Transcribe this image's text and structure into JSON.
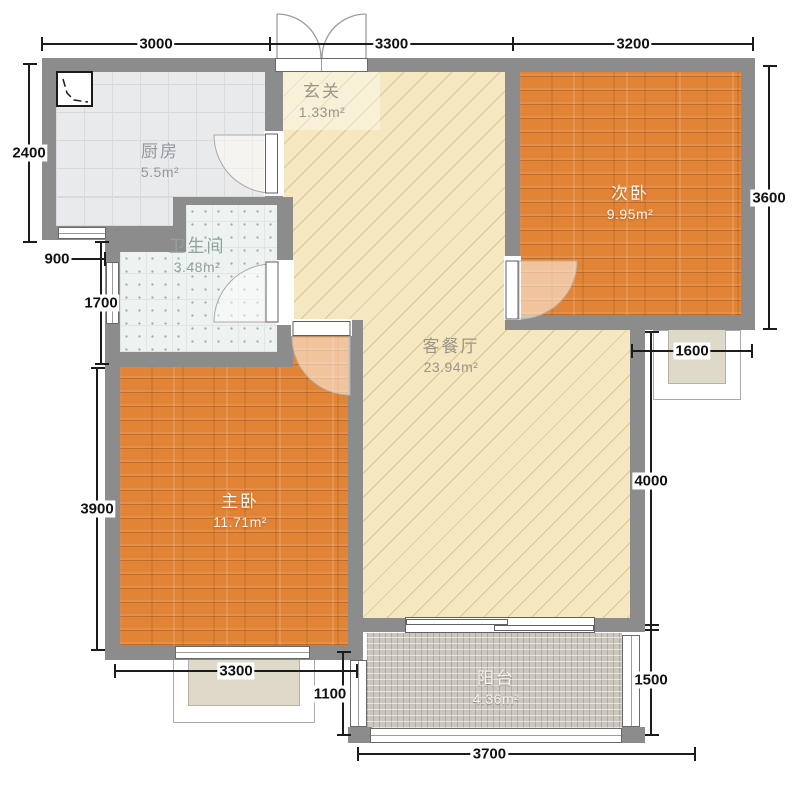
{
  "plan": {
    "rooms": {
      "kitchen": {
        "name": "厨房",
        "area": "5.5m²"
      },
      "hall": {
        "name": "玄关",
        "area": "1.33m²"
      },
      "bedroom2": {
        "name": "次卧",
        "area": "9.95m²"
      },
      "bath": {
        "name": "卫生间",
        "area": "3.48m²"
      },
      "living": {
        "name": "客餐厅",
        "area": "23.94m²"
      },
      "master": {
        "name": "主卧",
        "area": "11.71m²"
      },
      "balcony": {
        "name": "阳台",
        "area": "4.36m²"
      }
    },
    "dimensions": {
      "top": [
        "3000",
        "3300",
        "3200"
      ],
      "left": [
        "2400",
        "900",
        "1700",
        "3900"
      ],
      "right": [
        "3600",
        "1600",
        "4000",
        "1500"
      ],
      "bottom": [
        "3300",
        "1100",
        "3700"
      ]
    },
    "colors": {
      "wall": "#8c8c8c",
      "wood_floor": "#e28436",
      "living_floor": "#f5e7bf",
      "kitchen_tile": "#e9eaec",
      "bath_tile": "#eef3f1",
      "balcony_tile": "#cbc7bf",
      "bay_fill": "#ded9c9",
      "dimension_text": "#111111"
    }
  }
}
